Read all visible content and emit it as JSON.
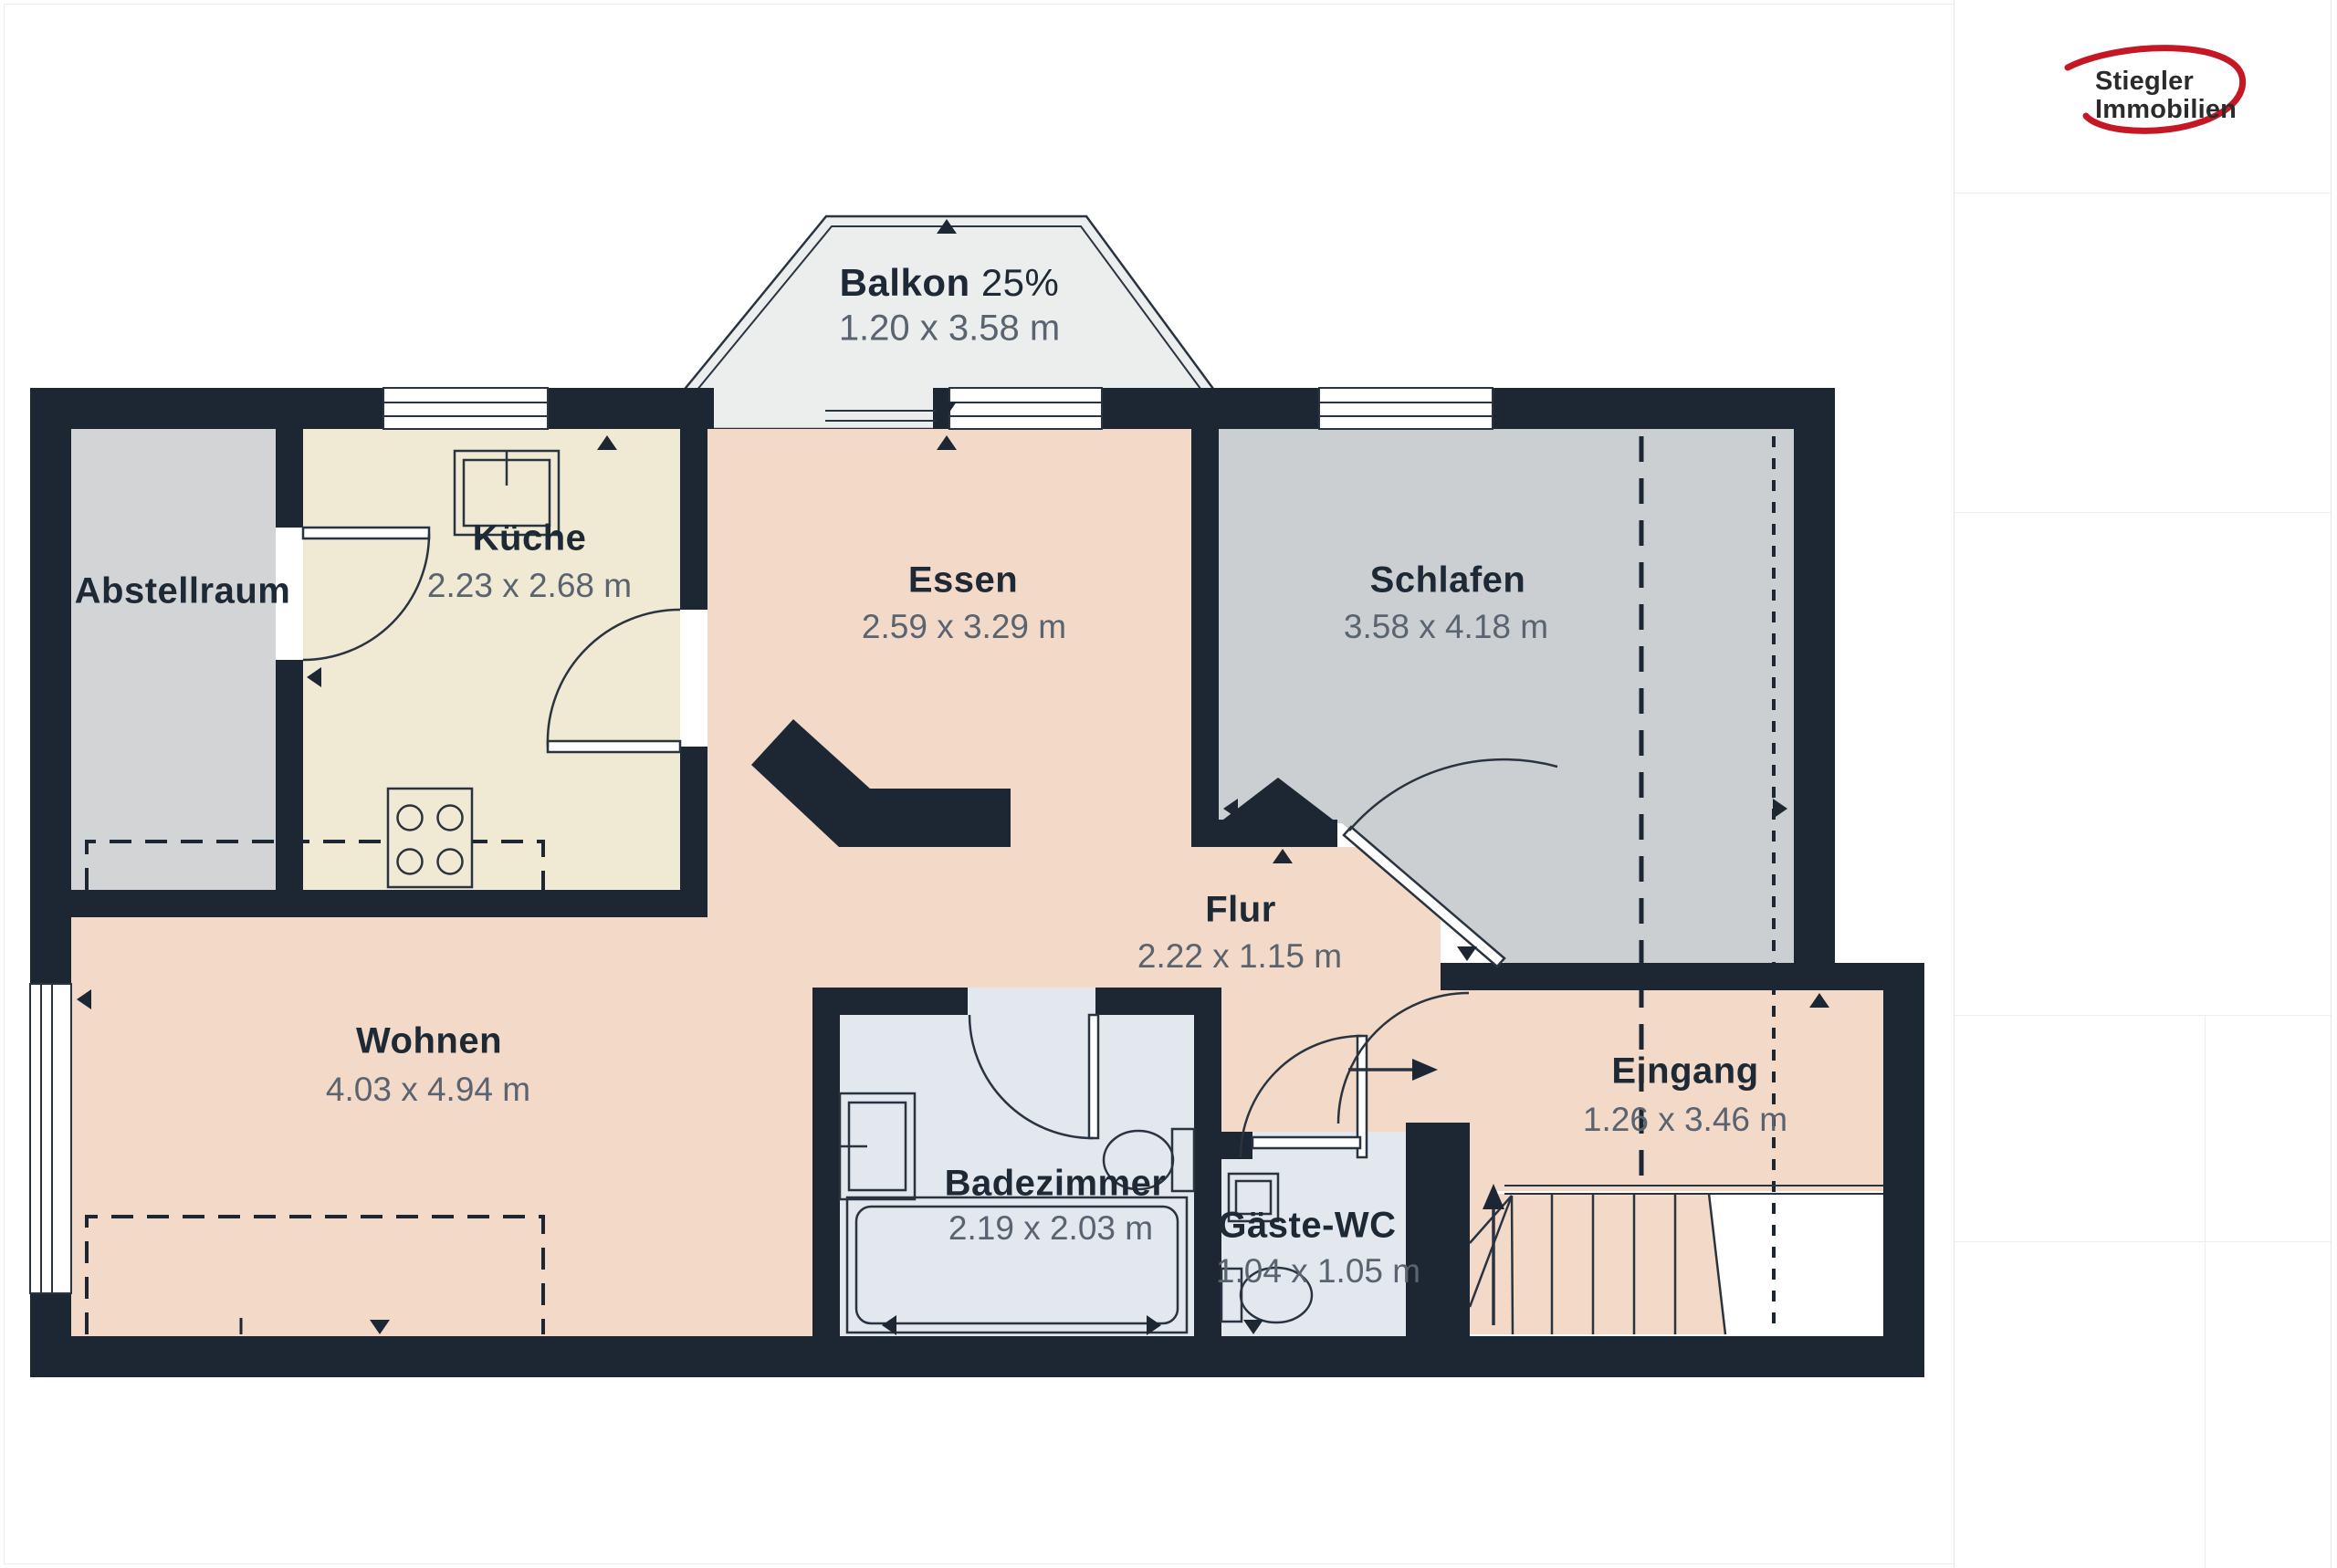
{
  "colors": {
    "wall": "#1d2734",
    "line": "#2a3440",
    "label": "#1e2936",
    "dim": "#5a6470",
    "floor_living": "#f3d9c8",
    "floor_kitchen": "#f0e9d3",
    "floor_storage": "#d3d4d6",
    "floor_bedroom": "#cccfd2",
    "floor_bath": "#e3e7ee",
    "floor_balcony": "#eceded",
    "brand_red": "#c51824",
    "brand_text": "#2b2b2b"
  },
  "brand": {
    "name_line1": "Stiegler",
    "name_line2": "Immobilien"
  },
  "rooms": [
    {
      "id": "balkon",
      "label": "Balkon",
      "suffix": "25%",
      "dims": "1.20 x 3.58 m"
    },
    {
      "id": "abstellraum",
      "label": "Abstellraum",
      "dims": ""
    },
    {
      "id": "kueche",
      "label": "Küche",
      "dims": "2.23 x 2.68 m"
    },
    {
      "id": "essen",
      "label": "Essen",
      "dims": "2.59 x 3.29 m"
    },
    {
      "id": "schlafen",
      "label": "Schlafen",
      "dims": "3.58 x 4.18 m"
    },
    {
      "id": "wohnen",
      "label": "Wohnen",
      "dims": "4.03 x 4.94 m"
    },
    {
      "id": "flur",
      "label": "Flur",
      "dims": "2.22 x 1.15 m"
    },
    {
      "id": "badezimmer",
      "label": "Badezimmer",
      "dims": "2.19 x 2.03 m"
    },
    {
      "id": "gaeste_wc",
      "label": "Gäste-WC",
      "dims": "1.04 x 1.05 m"
    },
    {
      "id": "eingang",
      "label": "Eingang",
      "dims": "1.26 x 3.46 m"
    }
  ]
}
